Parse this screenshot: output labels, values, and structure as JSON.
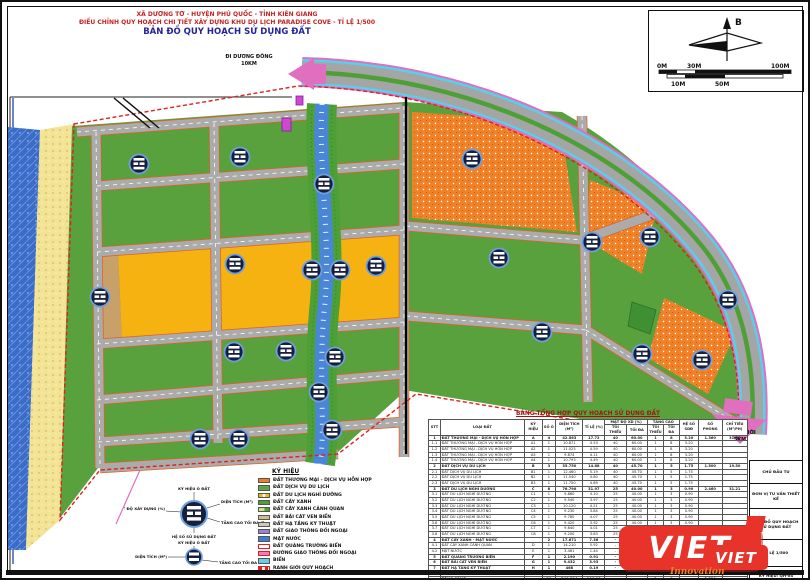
{
  "header": {
    "line1": "XÃ DƯƠNG TƠ - HUYỆN PHÚ QUỐC - TỈNH KIÊN GIANG",
    "line2": "ĐIỀU CHỈNH QUY HOẠCH CHI TIẾT XÂY DỰNG KHU DU LỊCH PARADISE COVE - TỈ LỆ 1/500",
    "line3": "BẢN ĐỒ QUY HOẠCH SỬ DỤNG ĐẤT"
  },
  "compass": {
    "north": "B"
  },
  "scalebar": {
    "top": [
      "0M",
      "30M",
      "100M"
    ],
    "bottom": [
      "10M",
      "50M"
    ]
  },
  "map": {
    "labels": {
      "duong_dong": "ĐI DƯƠNG ĐÔNG",
      "duong_dong_dist": "10KM",
      "an_thoi": "ĐI AN THỚI",
      "an_thoi_dist": "5KM"
    },
    "stamps": [
      [
        137,
        162
      ],
      [
        238,
        155
      ],
      [
        322,
        182
      ],
      [
        98,
        295
      ],
      [
        233,
        262
      ],
      [
        310,
        268
      ],
      [
        338,
        268
      ],
      [
        374,
        264
      ],
      [
        232,
        350
      ],
      [
        284,
        349
      ],
      [
        333,
        355
      ],
      [
        317,
        390
      ],
      [
        198,
        437
      ],
      [
        237,
        437
      ],
      [
        330,
        428
      ],
      [
        470,
        157
      ],
      [
        497,
        256
      ],
      [
        540,
        330
      ],
      [
        590,
        240
      ],
      [
        648,
        235
      ],
      [
        640,
        352
      ],
      [
        700,
        358
      ],
      [
        726,
        298
      ]
    ]
  },
  "legend": {
    "title": "KÝ HIỆU",
    "items": [
      {
        "label": "ĐẤT THƯƠNG MẠI - DỊCH VỤ HỖN HỢP",
        "color": "#ef7f1a",
        "type": "solid"
      },
      {
        "label": "ĐẤT DỊCH VỤ DU LỊCH",
        "color": "#58a83c",
        "type": "solid"
      },
      {
        "label": "ĐẤT DU LỊCH NGHỈ DƯỠNG",
        "color": "#f6b210",
        "type": "dot"
      },
      {
        "label": "ĐẤT CÂY XANH",
        "color": "#4f9e36",
        "type": "solid"
      },
      {
        "label": "ĐẤT CÂY XANH CẢNH QUAN",
        "color": "#cfe08a",
        "type": "dual"
      },
      {
        "label": "ĐẤT BÃI CÁT VEN BIỂN",
        "color": "#d9b98a",
        "type": "solid"
      },
      {
        "label": "ĐẤT HẠ TẦNG KỸ THUẬT",
        "color": "#cfc8b8",
        "type": "solid"
      },
      {
        "label": "ĐẤT GIAO THÔNG ĐỐI NGOẠI",
        "color": "#9b7fd4",
        "type": "solid"
      },
      {
        "label": "MẶT NƯỚC",
        "color": "#3f7fd0",
        "type": "solid"
      },
      {
        "label": "ĐẤT QUẢNG TRƯỜNG BIỂN",
        "color": "#ffffff",
        "type": "outline-red"
      },
      {
        "label": "ĐƯỜNG GIAO THÔNG ĐỐI NGOẠI",
        "color": "#ef7fc0",
        "type": "outline-red"
      },
      {
        "label": "BIỂN",
        "color": "#5fd0e8",
        "type": "solid"
      },
      {
        "label": "RANH GIỚI QUY HOẠCH",
        "color": "#e02020",
        "type": "dash"
      }
    ]
  },
  "stamp_diagram": {
    "big": {
      "top": "KÝ HIỆU Ô ĐẤT",
      "left": "MẬT ĐỘ XÂY DỰNG (%)",
      "right1": "DIỆN TÍCH (M²)",
      "right2": "TẦNG CAO TỐI ĐA (TẦNG)",
      "bottom": "HỆ SỐ SỬ DỤNG ĐẤT"
    },
    "small": {
      "top": "KÝ HIỆU Ô ĐẤT",
      "left": "DIỆN TÍCH (M²)",
      "right": "TẦNG CAO TỐI ĐA"
    }
  },
  "table": {
    "title": "BẢNG TỔNG HỢP QUY HOẠCH SỬ DỤNG ĐẤT",
    "columns": {
      "stt": "STT",
      "loai": "LOẠI ĐẤT",
      "kyhieu": "KÝ HIỆU",
      "soo": "SỐ Ô",
      "dientich": "DIỆN TÍCH (M²)",
      "tile": "TỈ LỆ (%)",
      "matdo": "MẬT ĐỘ XD (%)",
      "tangcao": "TẦNG CAO",
      "toithieu": "TỐI THIỂU",
      "toida": "TỐI ĐA",
      "heso": "HỆ SỐ SDĐ",
      "sophong": "SỐ PHÒNG",
      "chitieu": "CHỈ TIÊU (M²/PH)"
    },
    "rows": [
      [
        "1",
        "ĐẤT THƯƠNG MẠI - DỊCH VỤ HỖN HỢP",
        "A",
        "4",
        "42.563",
        "17.72",
        "40",
        "60.00",
        "1",
        "8",
        "3.20",
        "1.360",
        "31.30"
      ],
      [
        "1.1",
        "ĐẤT THƯƠNG MẠI - DỊCH VỤ HỖN HỢP",
        "A1",
        "1",
        "10.871",
        "4.53",
        "40",
        "60.00",
        "1",
        "8",
        "3.20",
        "",
        ""
      ],
      [
        "1.2",
        "ĐẤT THƯƠNG MẠI - DỊCH VỤ HỖN HỢP",
        "A2",
        "1",
        "11.025",
        "4.59",
        "40",
        "60.00",
        "1",
        "8",
        "3.20",
        "",
        ""
      ],
      [
        "1.3",
        "ĐẤT THƯƠNG MẠI - DỊCH VỤ HỖN HỢP",
        "A3",
        "1",
        "9.874",
        "4.11",
        "40",
        "60.00",
        "1",
        "8",
        "3.20",
        "",
        ""
      ],
      [
        "1.4",
        "ĐẤT THƯƠNG MẠI - DỊCH VỤ HỖN HỢP",
        "A4",
        "1",
        "10.793",
        "4.49",
        "40",
        "60.00",
        "1",
        "8",
        "3.20",
        "",
        ""
      ],
      [
        "2",
        "ĐẤT DỊCH VỤ DU LỊCH",
        "B",
        "3",
        "35.750",
        "14.88",
        "40",
        "45.70",
        "1",
        "5",
        "1.75",
        "1.500",
        "19.50"
      ],
      [
        "2.1",
        "ĐẤT DỊCH VỤ DU LỊCH",
        "B1",
        "1",
        "12.460",
        "5.19",
        "40",
        "45.70",
        "1",
        "5",
        "1.75",
        "",
        ""
      ],
      [
        "2.2",
        "ĐẤT DỊCH VỤ DU LỊCH",
        "B2",
        "1",
        "11.540",
        "4.80",
        "40",
        "45.70",
        "1",
        "5",
        "1.75",
        "",
        ""
      ],
      [
        "2.3",
        "ĐẤT DỊCH VỤ DU LỊCH",
        "B3",
        "1",
        "11.750",
        "4.89",
        "40",
        "45.70",
        "1",
        "5",
        "1.75",
        "",
        ""
      ],
      [
        "3",
        "ĐẤT DU LỊCH NGHỈ DƯỠNG",
        "C",
        "8",
        "76.790",
        "31.97",
        "25",
        "40.00",
        "1",
        "3",
        "0.90",
        "2.460",
        "31.21"
      ],
      [
        "3.1",
        "ĐẤT DU LỊCH NGHỈ DƯỠNG",
        "C1",
        "1",
        "9.860",
        "4.10",
        "25",
        "40.00",
        "1",
        "3",
        "0.90",
        "",
        ""
      ],
      [
        "3.2",
        "ĐẤT DU LỊCH NGHỈ DƯỠNG",
        "C2",
        "1",
        "9.540",
        "3.97",
        "25",
        "40.00",
        "1",
        "3",
        "0.90",
        "",
        ""
      ],
      [
        "3.3",
        "ĐẤT DU LỊCH NGHỈ DƯỠNG",
        "C3",
        "1",
        "10.120",
        "4.21",
        "25",
        "40.00",
        "1",
        "3",
        "0.90",
        "",
        ""
      ],
      [
        "3.4",
        "ĐẤT DU LỊCH NGHỈ DƯỠNG",
        "C4",
        "1",
        "9.230",
        "3.84",
        "25",
        "40.00",
        "1",
        "3",
        "0.90",
        "",
        ""
      ],
      [
        "3.5",
        "ĐẤT DU LỊCH NGHỈ DƯỠNG",
        "C5",
        "1",
        "9.780",
        "4.07",
        "25",
        "40.00",
        "1",
        "3",
        "0.90",
        "",
        ""
      ],
      [
        "3.6",
        "ĐẤT DU LỊCH NGHỈ DƯỠNG",
        "C6",
        "1",
        "9.420",
        "3.92",
        "25",
        "40.00",
        "1",
        "3",
        "0.90",
        "",
        ""
      ],
      [
        "3.7",
        "ĐẤT DU LỊCH NGHỈ DƯỠNG",
        "C7",
        "1",
        "9.640",
        "4.01",
        "25",
        "40.00",
        "1",
        "3",
        "0.90",
        "",
        ""
      ],
      [
        "3.8",
        "ĐẤT DU LỊCH NGHỈ DƯỠNG",
        "C8",
        "1",
        "9.200",
        "3.83",
        "25",
        "40.00",
        "1",
        "3",
        "0.90",
        "",
        ""
      ],
      [
        "4",
        "ĐẤT CÂY XANH - MẶT NƯỚC",
        "",
        "2",
        "17.671",
        "7.36",
        "-",
        "-",
        "-",
        "-",
        "-",
        "",
        ""
      ],
      [
        "4.1",
        "ĐẤT CÂY XANH CẢNH QUAN",
        "D",
        "1",
        "14.210",
        "5.92",
        "-",
        "-",
        "-",
        "-",
        "-",
        "",
        ""
      ],
      [
        "4.2",
        "MẶT NƯỚC",
        "E",
        "1",
        "3.461",
        "1.44",
        "-",
        "-",
        "-",
        "-",
        "-",
        "",
        ""
      ],
      [
        "5",
        "ĐẤT QUẢNG TRƯỜNG BIỂN",
        "F",
        "1",
        "2.190",
        "0.91",
        "-",
        "-",
        "-",
        "-",
        "-",
        "",
        ""
      ],
      [
        "6",
        "ĐẤT BÃI CÁT VEN BIỂN",
        "G",
        "1",
        "9.432",
        "3.93",
        "-",
        "-",
        "-",
        "-",
        "-",
        "",
        ""
      ],
      [
        "7",
        "ĐẤT HẠ TẦNG KỸ THUẬT",
        "H",
        "1",
        "468",
        "0.19",
        "-",
        "25.00",
        "1",
        "1",
        "0.25",
        "",
        ""
      ],
      [
        "8",
        "ĐẤT GIAO THÔNG",
        "",
        "",
        "55.330",
        "23.04",
        "-",
        "-",
        "-",
        "-",
        "-",
        "",
        ""
      ]
    ],
    "total": [
      "",
      "TỔNG CỘNG",
      "",
      "20",
      "240.194",
      "100.00",
      "-",
      "-",
      "1",
      "8",
      "-",
      "5.320",
      "-"
    ]
  },
  "title_block": {
    "rows": [
      "CHỦ ĐẦU TƯ",
      "ĐƠN VỊ TƯ VẤN THIẾT KẾ",
      "BẢN ĐỒ QUY HOẠCH SỬ DỤNG ĐẤT",
      "TỈ LỆ 1/500",
      "KÝ HIỆU: QH-04"
    ]
  },
  "watermark": {
    "big": "VIET",
    "small": "VIET",
    "tagline": "Innovation"
  }
}
